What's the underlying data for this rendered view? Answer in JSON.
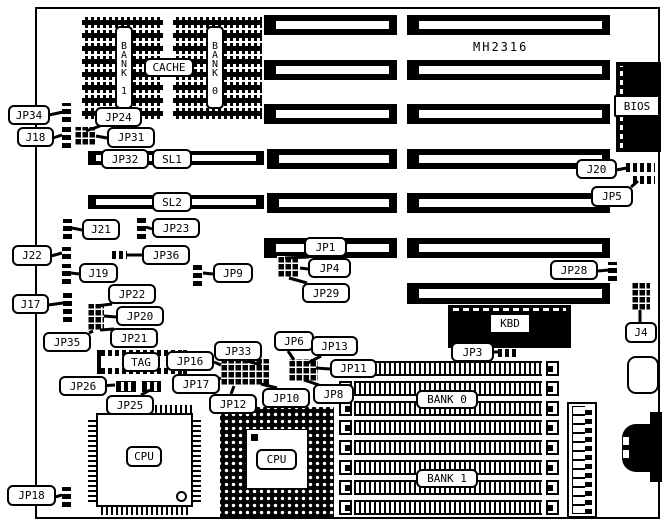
{
  "diagram": {
    "board_model": "MH2316",
    "labels": {
      "jp34": "JP34",
      "j18": "J18",
      "jp24": "JP24",
      "jp31": "JP31",
      "jp32": "JP32",
      "sl1": "SL1",
      "sl2": "SL2",
      "j21": "J21",
      "jp23": "JP23",
      "j22": "J22",
      "jp36": "JP36",
      "j19": "J19",
      "jp9": "JP9",
      "j17": "J17",
      "jp22": "JP22",
      "jp20": "JP20",
      "jp21": "JP21",
      "jp35": "JP35",
      "jp1": "JP1",
      "jp4": "JP4",
      "jp29": "JP29",
      "j20": "J20",
      "jp5": "JP5",
      "jp28": "JP28",
      "j4": "J4",
      "jp6": "JP6",
      "jp13": "JP13",
      "jp33": "JP33",
      "jp16": "JP16",
      "jp17": "JP17",
      "jp11": "JP11",
      "jp8": "JP8",
      "jp10": "JP10",
      "jp12": "JP12",
      "jp26": "JP26",
      "jp25": "JP25",
      "jp18": "JP18",
      "jp3": "JP3",
      "tag": "TAG"
    },
    "components": {
      "cache": "CACHE",
      "cache_bank1": "BANK 1",
      "cache_bank0": "BANK 0",
      "kbd": "KBD",
      "bios": "BIOS",
      "cpu_qfp": "CPU",
      "cpu_pga": "CPU",
      "simm_bank0": "BANK 0",
      "simm_bank1": "BANK 1"
    }
  }
}
